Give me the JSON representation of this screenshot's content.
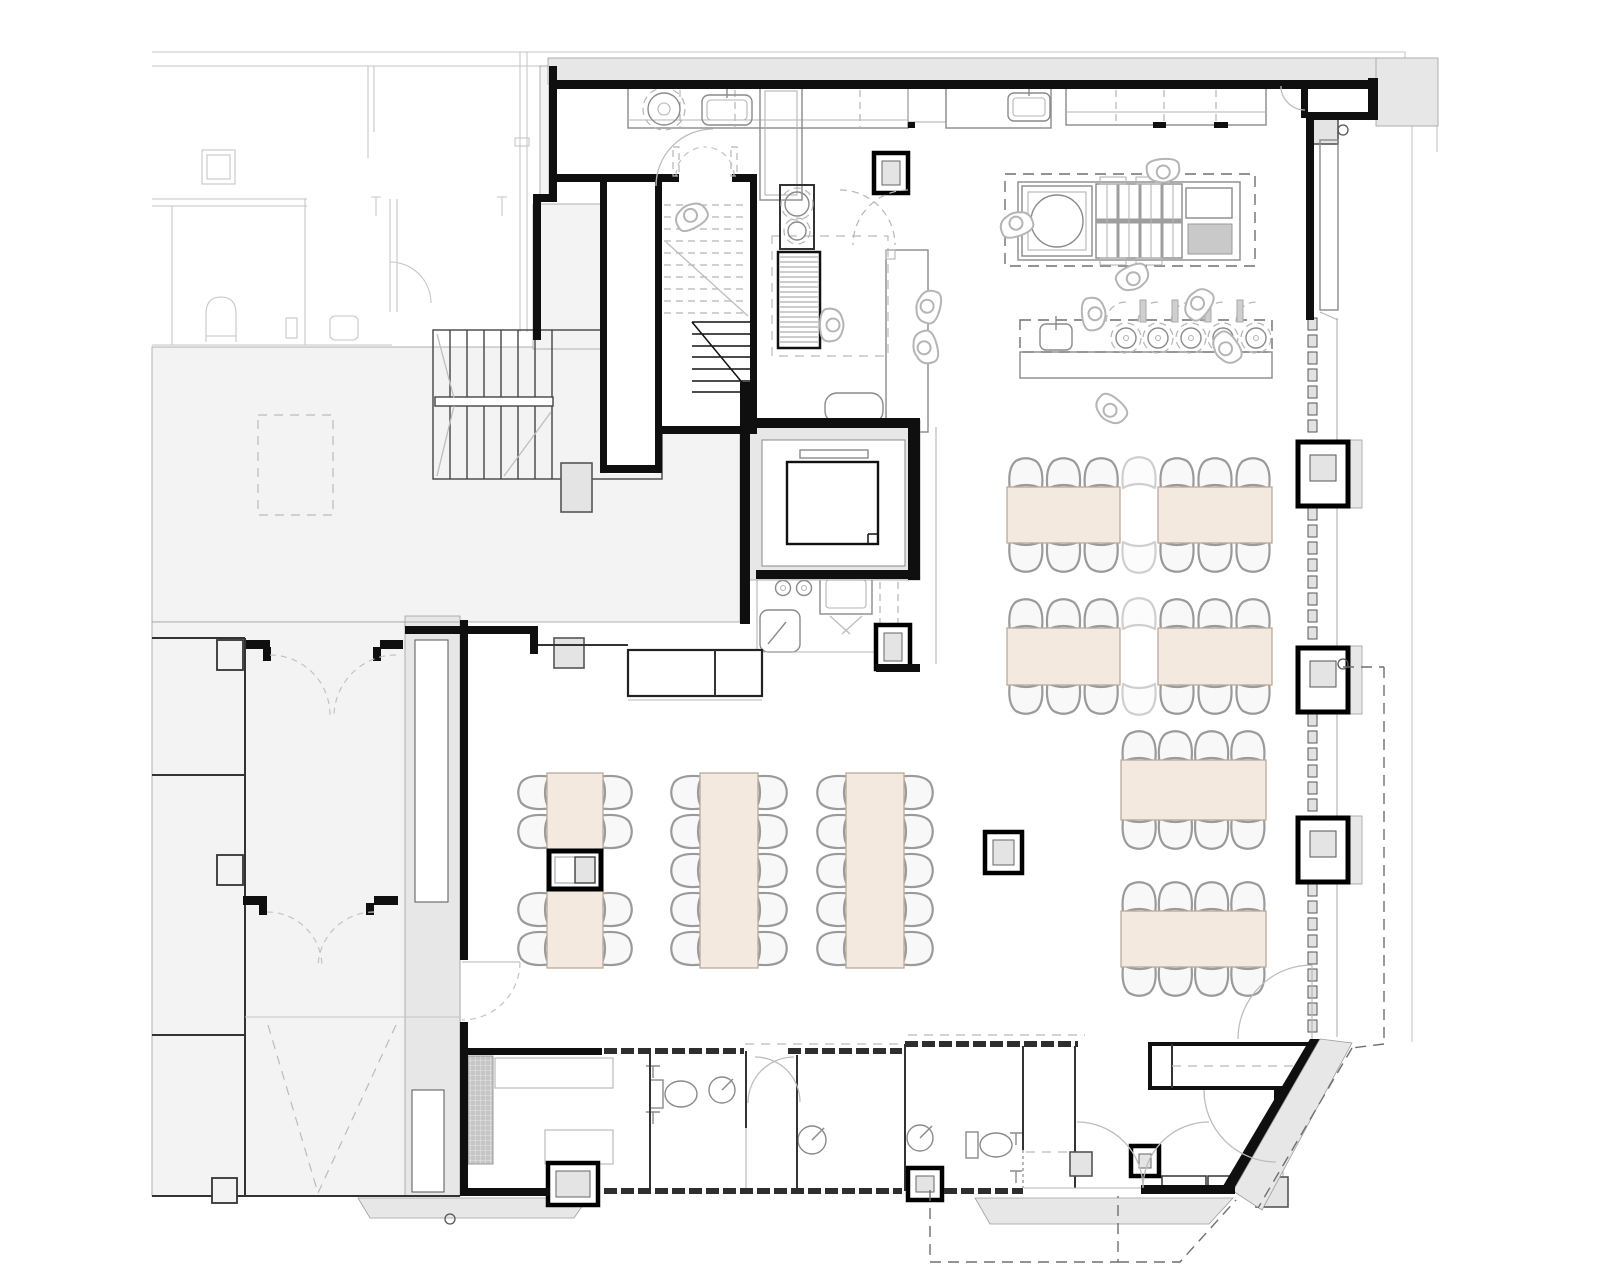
{
  "colors": {
    "background": "#ffffff",
    "wall_black": "#0f0f0f",
    "wall_poche": "#e7e7e7",
    "adjacent_zone_fill": "#f3f3f3",
    "table_fill": "#f3e9de",
    "table_stroke": "#b9ab9b",
    "chair_fill": "#f8f8f8",
    "chair_stroke": "#9a9a9a",
    "ghost_chair_stroke": "#cfcfcf",
    "column_fill": "#e4e4e4",
    "equipment_gray": "#c9c9c9",
    "light_line": "#b5b5b5"
  },
  "furniture": {
    "dining_tables": [
      {
        "name": "table-a1-upper",
        "x": 547,
        "y": 773,
        "w": 56,
        "h": 78,
        "chairs": {
          "left": 2,
          "right": 2
        }
      },
      {
        "name": "table-a1-lower",
        "x": 547,
        "y": 890,
        "w": 56,
        "h": 78,
        "chairs": {
          "left": 2,
          "right": 2
        }
      },
      {
        "name": "table-a2",
        "x": 700,
        "y": 773,
        "w": 58,
        "h": 195,
        "chairs": {
          "left": 5,
          "right": 5
        }
      },
      {
        "name": "table-a3",
        "x": 846,
        "y": 773,
        "w": 58,
        "h": 195,
        "chairs": {
          "left": 5,
          "right": 5
        }
      },
      {
        "name": "table-b1-left",
        "x": 1007,
        "y": 487,
        "w": 113,
        "h": 56,
        "chairs": {
          "top": 3,
          "bottom": 3
        }
      },
      {
        "name": "table-b1-right",
        "x": 1158,
        "y": 487,
        "w": 114,
        "h": 56,
        "chairs": {
          "top": 3,
          "bottom": 3
        }
      },
      {
        "name": "table-b2-left",
        "x": 1007,
        "y": 628,
        "w": 113,
        "h": 57,
        "chairs": {
          "top": 3,
          "bottom": 3
        }
      },
      {
        "name": "table-b2-right",
        "x": 1158,
        "y": 628,
        "w": 114,
        "h": 57,
        "chairs": {
          "top": 3,
          "bottom": 3
        }
      },
      {
        "name": "table-c1",
        "x": 1121,
        "y": 760,
        "w": 145,
        "h": 60,
        "chairs": {
          "top": 4,
          "bottom": 4
        }
      },
      {
        "name": "table-c2",
        "x": 1121,
        "y": 911,
        "w": 145,
        "h": 56,
        "chairs": {
          "top": 4,
          "bottom": 4
        }
      }
    ],
    "ghost_chairs": [
      {
        "x": 1139,
        "y": 473,
        "r": 0
      },
      {
        "x": 1139,
        "y": 557,
        "r": 180
      },
      {
        "x": 1139,
        "y": 614,
        "r": 0
      },
      {
        "x": 1139,
        "y": 699,
        "r": 180
      }
    ],
    "columns": [
      {
        "name": "column-dining-center",
        "type": "framed",
        "x": 985,
        "y": 832,
        "w": 37,
        "h": 41
      },
      {
        "name": "column-table-a1",
        "type": "framed-split",
        "x": 549,
        "y": 851,
        "w": 52,
        "h": 38
      },
      {
        "name": "column-kitchen",
        "type": "framed",
        "x": 874,
        "y": 153,
        "w": 34,
        "h": 40
      },
      {
        "name": "column-dishroom",
        "type": "framed",
        "x": 876,
        "y": 625,
        "w": 34,
        "h": 44
      },
      {
        "name": "column-vestibule",
        "type": "framed",
        "x": 1131,
        "y": 1146,
        "w": 28,
        "h": 30
      },
      {
        "name": "column-pod-west",
        "type": "framed",
        "x": 548,
        "y": 1163,
        "w": 50,
        "h": 42
      },
      {
        "name": "column-pod-east",
        "type": "framed",
        "x": 908,
        "y": 1168,
        "w": 34,
        "h": 32
      },
      {
        "name": "column-entry-mat",
        "type": "gray",
        "x": 1256,
        "y": 1177,
        "w": 32,
        "h": 30
      },
      {
        "name": "column-entry-small",
        "type": "gray",
        "x": 1070,
        "y": 1152,
        "w": 22,
        "h": 24
      },
      {
        "name": "column-stair-landing",
        "type": "gray",
        "x": 561,
        "y": 463,
        "w": 31,
        "h": 49
      },
      {
        "name": "column-west-wall",
        "type": "gray",
        "x": 554,
        "y": 638,
        "w": 30,
        "h": 30
      },
      {
        "name": "column-facade-top",
        "type": "gray",
        "x": 1312,
        "y": 118,
        "w": 26,
        "h": 26
      },
      {
        "name": "column-corridor-1",
        "type": "plain",
        "x": 217,
        "y": 640,
        "w": 26,
        "h": 30
      },
      {
        "name": "column-corridor-2",
        "type": "plain",
        "x": 217,
        "y": 855,
        "w": 26,
        "h": 30
      },
      {
        "name": "column-corridor-3",
        "type": "plain",
        "x": 212,
        "y": 1178,
        "w": 25,
        "h": 25
      }
    ]
  },
  "facade": {
    "x": 1308,
    "segment": 12,
    "gap": 5,
    "piers": [
      {
        "y": 442
      },
      {
        "y": 648
      },
      {
        "y": 818
      }
    ],
    "pier_w": 50,
    "pier_h": 64,
    "glazing_bands": [
      {
        "y": 318,
        "h": 124
      },
      {
        "y": 508,
        "h": 140
      },
      {
        "y": 714,
        "h": 104
      },
      {
        "y": 884,
        "h": 153
      }
    ]
  },
  "persons": [
    {
      "x": 692,
      "y": 218,
      "r": -30
    },
    {
      "x": 830,
      "y": 325,
      "r": 90
    },
    {
      "x": 930,
      "y": 307,
      "r": -75
    },
    {
      "x": 927,
      "y": 347,
      "r": -105
    },
    {
      "x": 1017,
      "y": 226,
      "r": -20
    },
    {
      "x": 1163,
      "y": 169,
      "r": 175
    },
    {
      "x": 1132,
      "y": 276,
      "r": 155
    },
    {
      "x": 1092,
      "y": 314,
      "r": 85
    },
    {
      "x": 1200,
      "y": 305,
      "r": -55
    },
    {
      "x": 1228,
      "y": 347,
      "r": -125
    },
    {
      "x": 1112,
      "y": 408,
      "r": -140
    }
  ],
  "markers": [
    {
      "x": 1343,
      "y": 130
    },
    {
      "x": 1343,
      "y": 664
    },
    {
      "x": 450,
      "y": 1219
    }
  ]
}
